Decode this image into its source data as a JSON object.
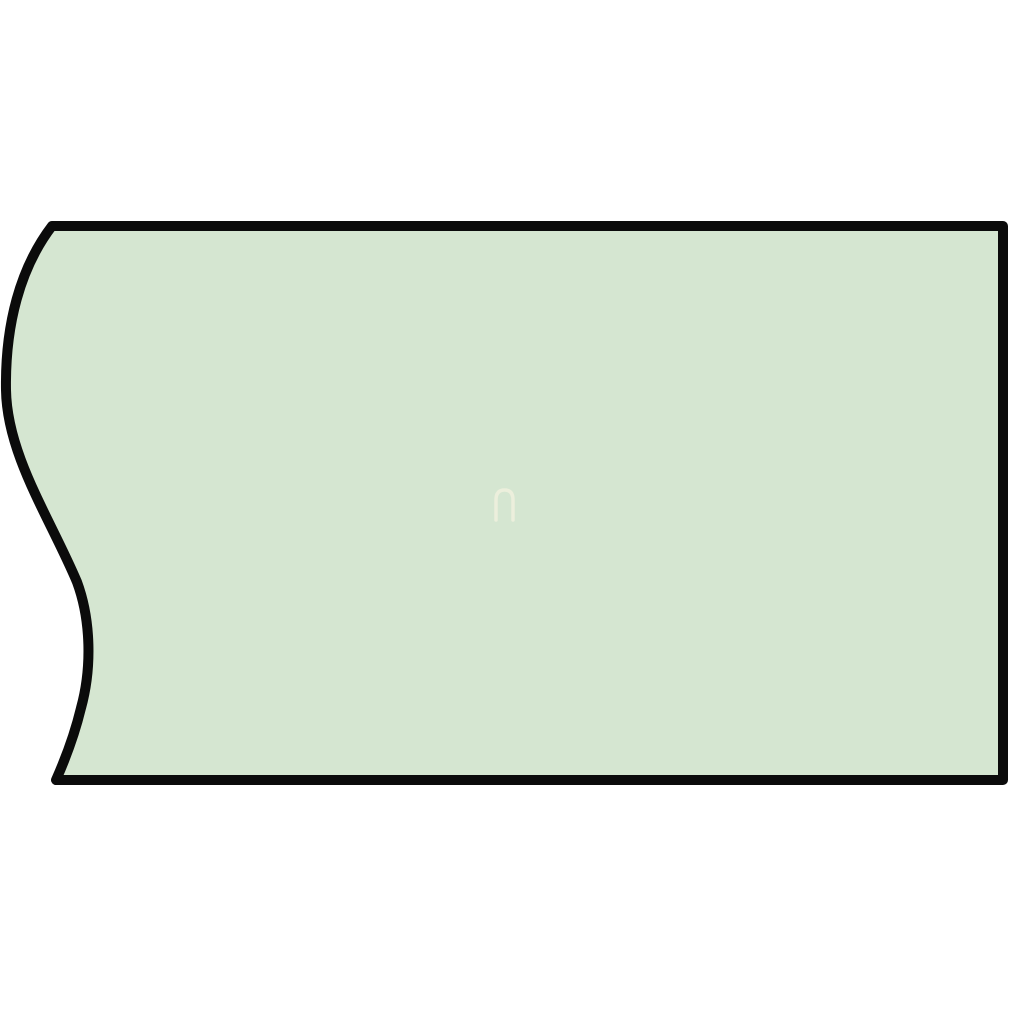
{
  "canvas": {
    "width": 1010,
    "height": 1010,
    "background_color": "#ffffff"
  },
  "shape": {
    "description": "bar cross-section with wavy break edge on left",
    "fill_color": "#d5e6d1",
    "stroke_color": "#0b0b0b",
    "stroke_width": 10,
    "path": "M 52 226 C 20 268, 5 325, 6 390 C 7 455, 50 518, 77 582 C 91 620, 92 668, 81 708 C 74 737, 64 762, 56 780 L 1003 780 L 1003 226 Z"
  },
  "watermark": {
    "glyph": "n-arch",
    "stroke_color": "#f3f1df",
    "stroke_width": 3.5,
    "opacity": 0.75,
    "path": "M 496 520 L 496 500 Q 496 490 504.5 490 Q 513 490 513 500 L 513 520"
  }
}
